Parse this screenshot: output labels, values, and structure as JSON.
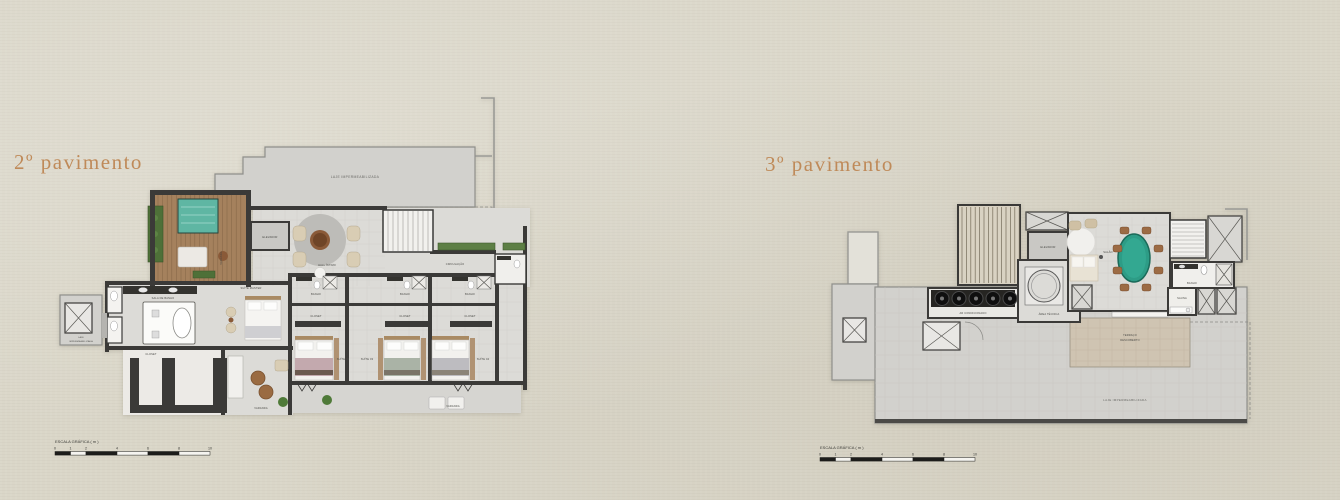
{
  "titles": {
    "left": "2º pavimento",
    "right": "3º pavimento"
  },
  "scale_bar": {
    "label": "ESCALA GRÁFICA ( m )",
    "ticks": [
      "0",
      "1",
      "2",
      "4",
      "6",
      "8",
      "10"
    ]
  },
  "left_plan": {
    "laje_top": "LAJE IMPERMEABILIZADA",
    "laje_side_line1": "LAJE",
    "laje_side_line2": "IMPERMEABILIZADA",
    "varanda_pool": "VARANDA",
    "elevador": "ELEVADOR",
    "hall_intimo": "HALL ÍNTIMO",
    "circulacao": "CIRCULAÇÃO",
    "sala_de_banho": "SALA DE BANHO",
    "closet_master": "CLOSET",
    "suite_master": "SUÍTE MASTER",
    "varanda_master": "VARANDA",
    "varanda_suites": "VARANDA",
    "suites": [
      {
        "name": "SUÍTE 02",
        "banho": "BANHO",
        "closet": "CLOSET"
      },
      {
        "name": "SUÍTE 03",
        "banho": "BANHO",
        "closet": "CLOSET"
      },
      {
        "name": "SUÍTE 04",
        "banho": "BANHO",
        "closet": "CLOSET"
      }
    ]
  },
  "right_plan": {
    "elevador": "ELEVADOR",
    "salao": "SALÃO",
    "area_tecnica": "ÁREA TÉCNICA",
    "ar_condicionado": "AR CONDICIONADO",
    "banho": "BANHO",
    "sauna": "SAUNA",
    "terraco_line1": "TERRAÇO",
    "terraco_line2": "DESCOBERTO",
    "laje": "LAJE IMPERMEABILIZADA"
  },
  "colors": {
    "background": "#dad6c8",
    "title": "#bf8a59",
    "walls": "#3b3a38",
    "pool": "#5fb6a3",
    "deck_wood": "#a5815d",
    "planter_green": "#4e7038",
    "dining_table": "#2d9c86",
    "laje_grey": "#d2d1cd",
    "terrace_beige": "#cfc4b2"
  }
}
